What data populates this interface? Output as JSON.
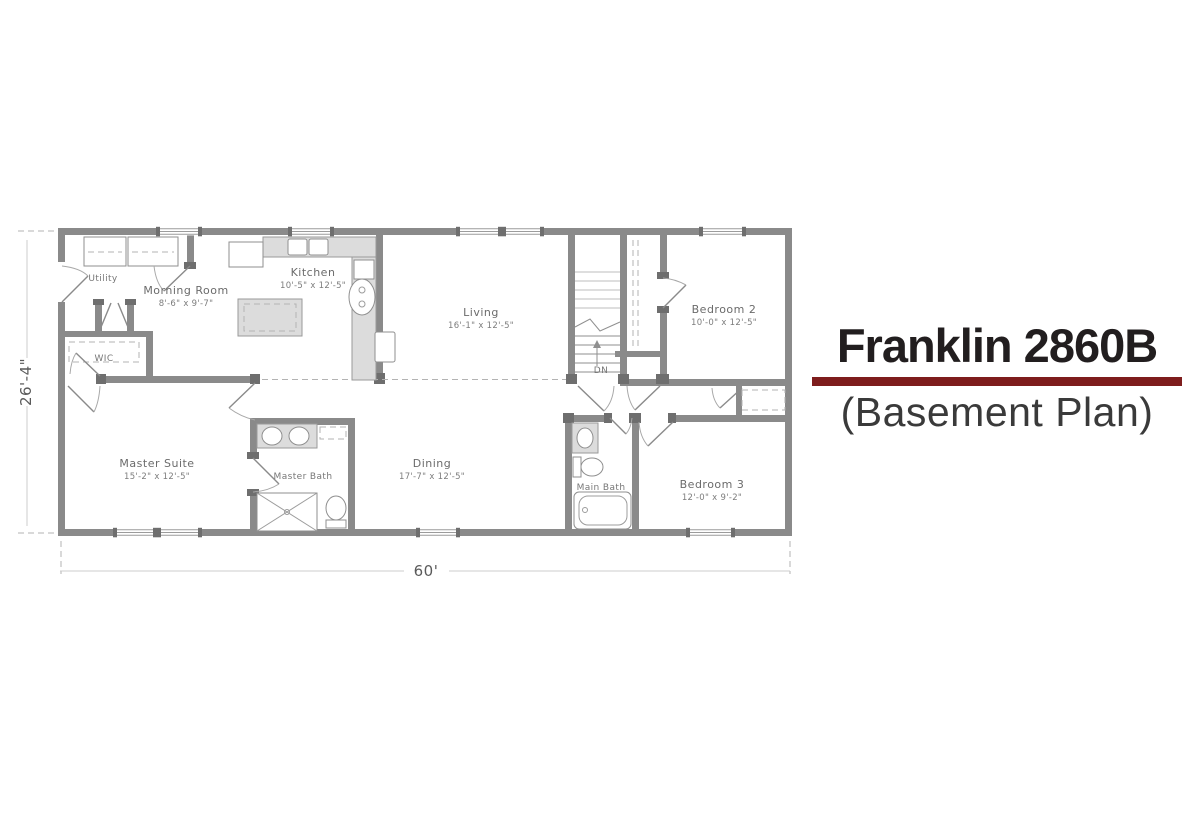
{
  "title": {
    "name": "Franklin 2860B",
    "subtitle": "(Basement Plan)",
    "accent_color": "#7e1d1d",
    "title_color": "#221e1f",
    "subtitle_color": "#3a3a3a"
  },
  "plan": {
    "overall_width_label": "60'",
    "overall_depth_label": "26'-4\"",
    "stairs_label": "DN",
    "colors": {
      "wall": "#8a8a8a",
      "fixture_fill": "#dcdcdc",
      "label": "#6b6b6b"
    },
    "rooms": [
      {
        "id": "utility",
        "label": "Utility",
        "dims": ""
      },
      {
        "id": "morning-room",
        "label": "Morning Room",
        "dims": "8'-6\" x 9'-7\""
      },
      {
        "id": "kitchen",
        "label": "Kitchen",
        "dims": "10'-5\" x 12'-5\""
      },
      {
        "id": "living",
        "label": "Living",
        "dims": "16'-1\" x 12'-5\""
      },
      {
        "id": "bedroom-2",
        "label": "Bedroom 2",
        "dims": "10'-0\" x 12'-5\""
      },
      {
        "id": "wic",
        "label": "WIC",
        "dims": ""
      },
      {
        "id": "master-suite",
        "label": "Master Suite",
        "dims": "15'-2\" x 12'-5\""
      },
      {
        "id": "master-bath",
        "label": "Master Bath",
        "dims": ""
      },
      {
        "id": "dining",
        "label": "Dining",
        "dims": "17'-7\" x 12'-5\""
      },
      {
        "id": "main-bath",
        "label": "Main Bath",
        "dims": ""
      },
      {
        "id": "bedroom-3",
        "label": "Bedroom 3",
        "dims": "12'-0\" x 9'-2\""
      }
    ]
  }
}
